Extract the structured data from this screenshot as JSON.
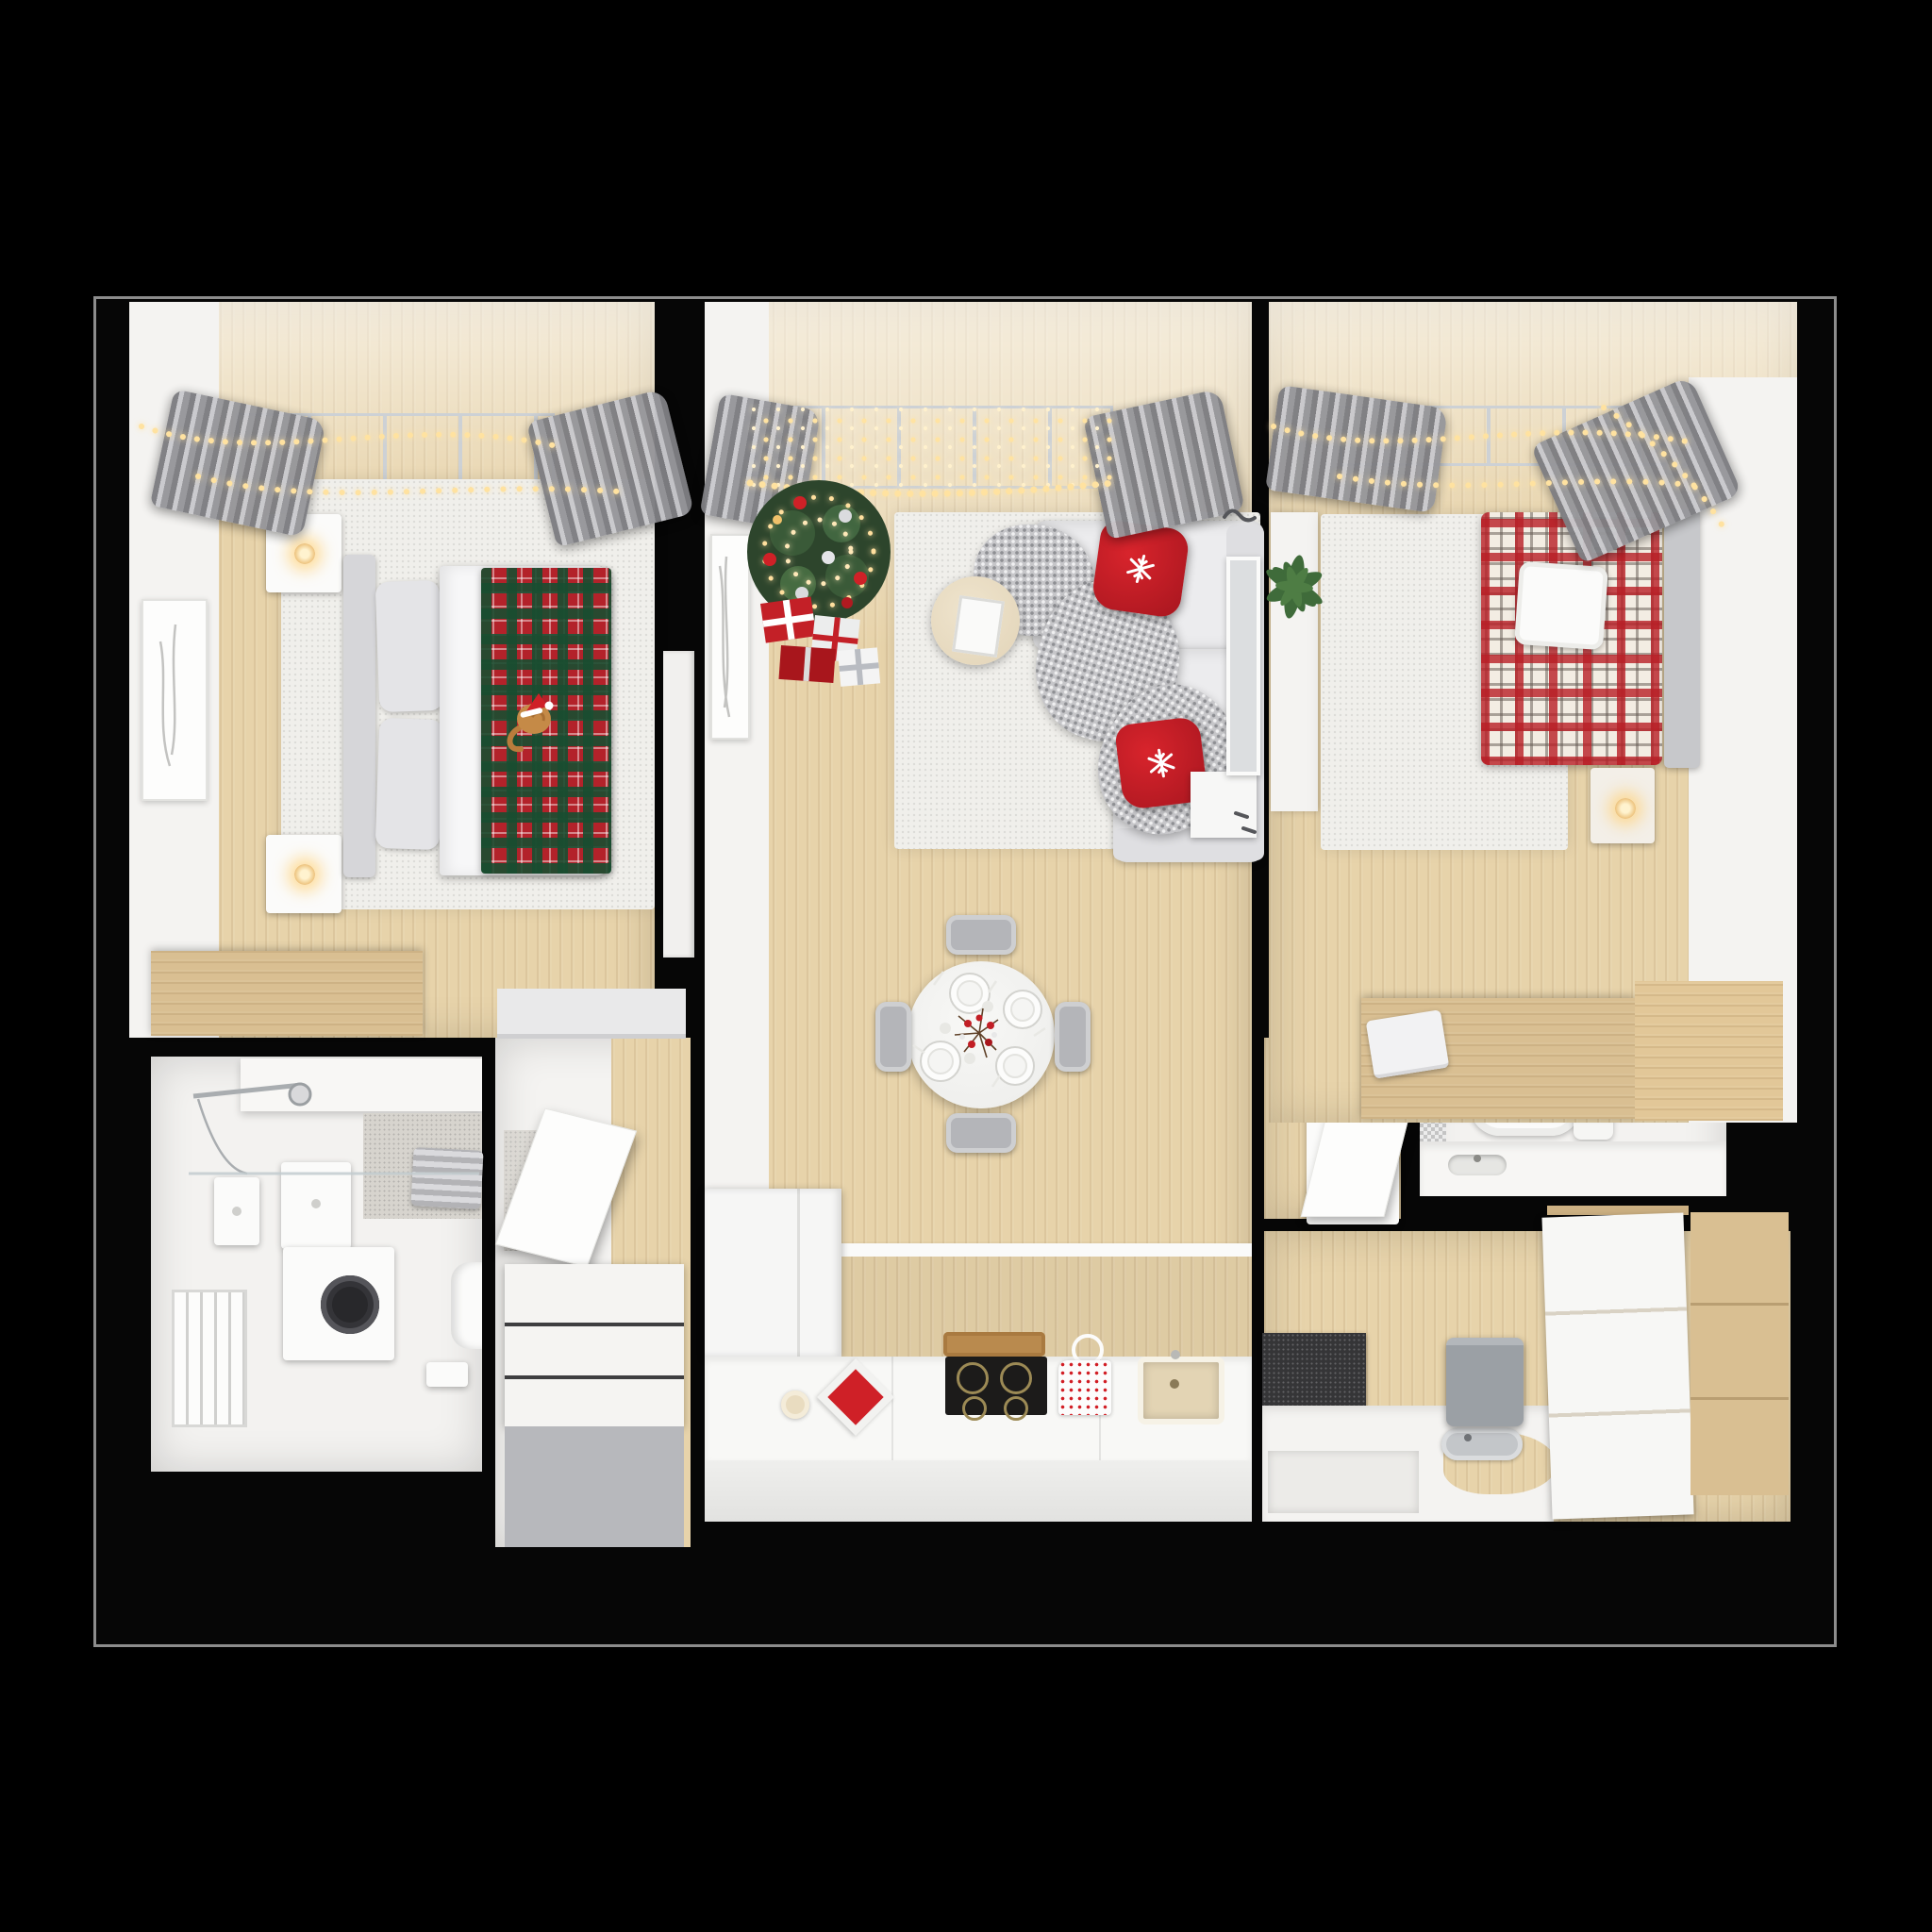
{
  "scene": {
    "title": "3D top-down floor plan of an apartment decorated for Christmas",
    "view": "dollhouse top view render",
    "background_color": "#000000",
    "palette": {
      "slab_black": "#060606",
      "slab_edge_gray": "#8c8c8c",
      "floor_wood": "#e7d3aa",
      "furniture_wood": "#d9bf92",
      "wall_white": "#f4f3f1",
      "rug_white": "#f0efeb",
      "curtain_gray": "#a7a7ab",
      "accent_red": "#c2222a",
      "tartan_green": "#2c5d3f",
      "string_light_gold": "#ffe2a0",
      "cooktop_black": "#1c1b1a",
      "mat_dark": "#353537",
      "sink_beige": "#e3d4b4"
    },
    "rooms": [
      {
        "id": "bedroom-1",
        "name": "Bedroom 1",
        "position": "top-left",
        "items": [
          "window with string lights",
          "gray curtains",
          "double bed with white duvet",
          "red-green tartan plaid throw",
          "cat wearing santa hat",
          "gray headboard and pillows",
          "nightstand with candle (x2)",
          "white rug",
          "framed wall art",
          "wooden desk",
          "white door"
        ]
      },
      {
        "id": "living-room",
        "name": "Living room",
        "position": "top-center",
        "items": [
          "window with light curtain of string lights",
          "gray curtains",
          "decorated christmas tree with gold lights and baubles",
          "gift boxes",
          "white rug",
          "round cream coffee table with photo frame",
          "white corner sofa",
          "chunky gray knit throw",
          "red snowflake pillow (x2)",
          "round dining table with 4 gray chairs",
          "4 place settings",
          "red berry centerpiece",
          "framed art on wall",
          "leaning mirror",
          "white sideboard",
          "wall hooks"
        ]
      },
      {
        "id": "kitchen",
        "name": "Kitchen",
        "position": "bottom-center",
        "items": [
          "tall white fridge cabinet",
          "wood panel backsplash",
          "white counter",
          "induction cooktop with gold rings",
          "wooden tray",
          "red trivet",
          "ceramic plate",
          "red polka-dot towel",
          "beige sink"
        ]
      },
      {
        "id": "bathroom-1",
        "name": "Bathroom",
        "position": "bottom-left",
        "items": [
          "shower rail and shower head",
          "glass partition",
          "tiled shower floor",
          "gray towels",
          "wall shelf",
          "wall-hung cabinets",
          "washing machine",
          "towel radiator",
          "toilet",
          "paper holder"
        ]
      },
      {
        "id": "hallway",
        "name": "Entry hall",
        "position": "bottom-left-center",
        "items": [
          "wardrobe with open flap door",
          "wood panel wall",
          "shoe bench with gray front",
          "closet top"
        ]
      },
      {
        "id": "hallway-2",
        "name": "Inner hall",
        "position": "right-of-living",
        "items": [
          "wall cabinet with open door"
        ]
      },
      {
        "id": "wc",
        "name": "WC",
        "position": "bottom-right-upper",
        "items": [
          "wall-hung toilet with cistern",
          "gray mosaic tile",
          "white vanity counter with sink slot"
        ]
      },
      {
        "id": "bedroom-2",
        "name": "Bedroom 2",
        "position": "top-right",
        "items": [
          "window with string lights",
          "gray curtains",
          "bed with red-white tartan duvet",
          "white quilted pillow",
          "gray headboard",
          "nightstand with candle",
          "white rug",
          "potted green plant",
          "white wardrobe column",
          "wooden desk",
          "white laptop"
        ]
      },
      {
        "id": "bathroom-2",
        "name": "Second bathroom",
        "position": "bottom-right",
        "items": [
          "dark checkered floor mat",
          "gray laundry bin",
          "white bath deck with wood cutout",
          "gray oval basin",
          "white drawer unit",
          "wooden cabinet column"
        ]
      }
    ]
  }
}
